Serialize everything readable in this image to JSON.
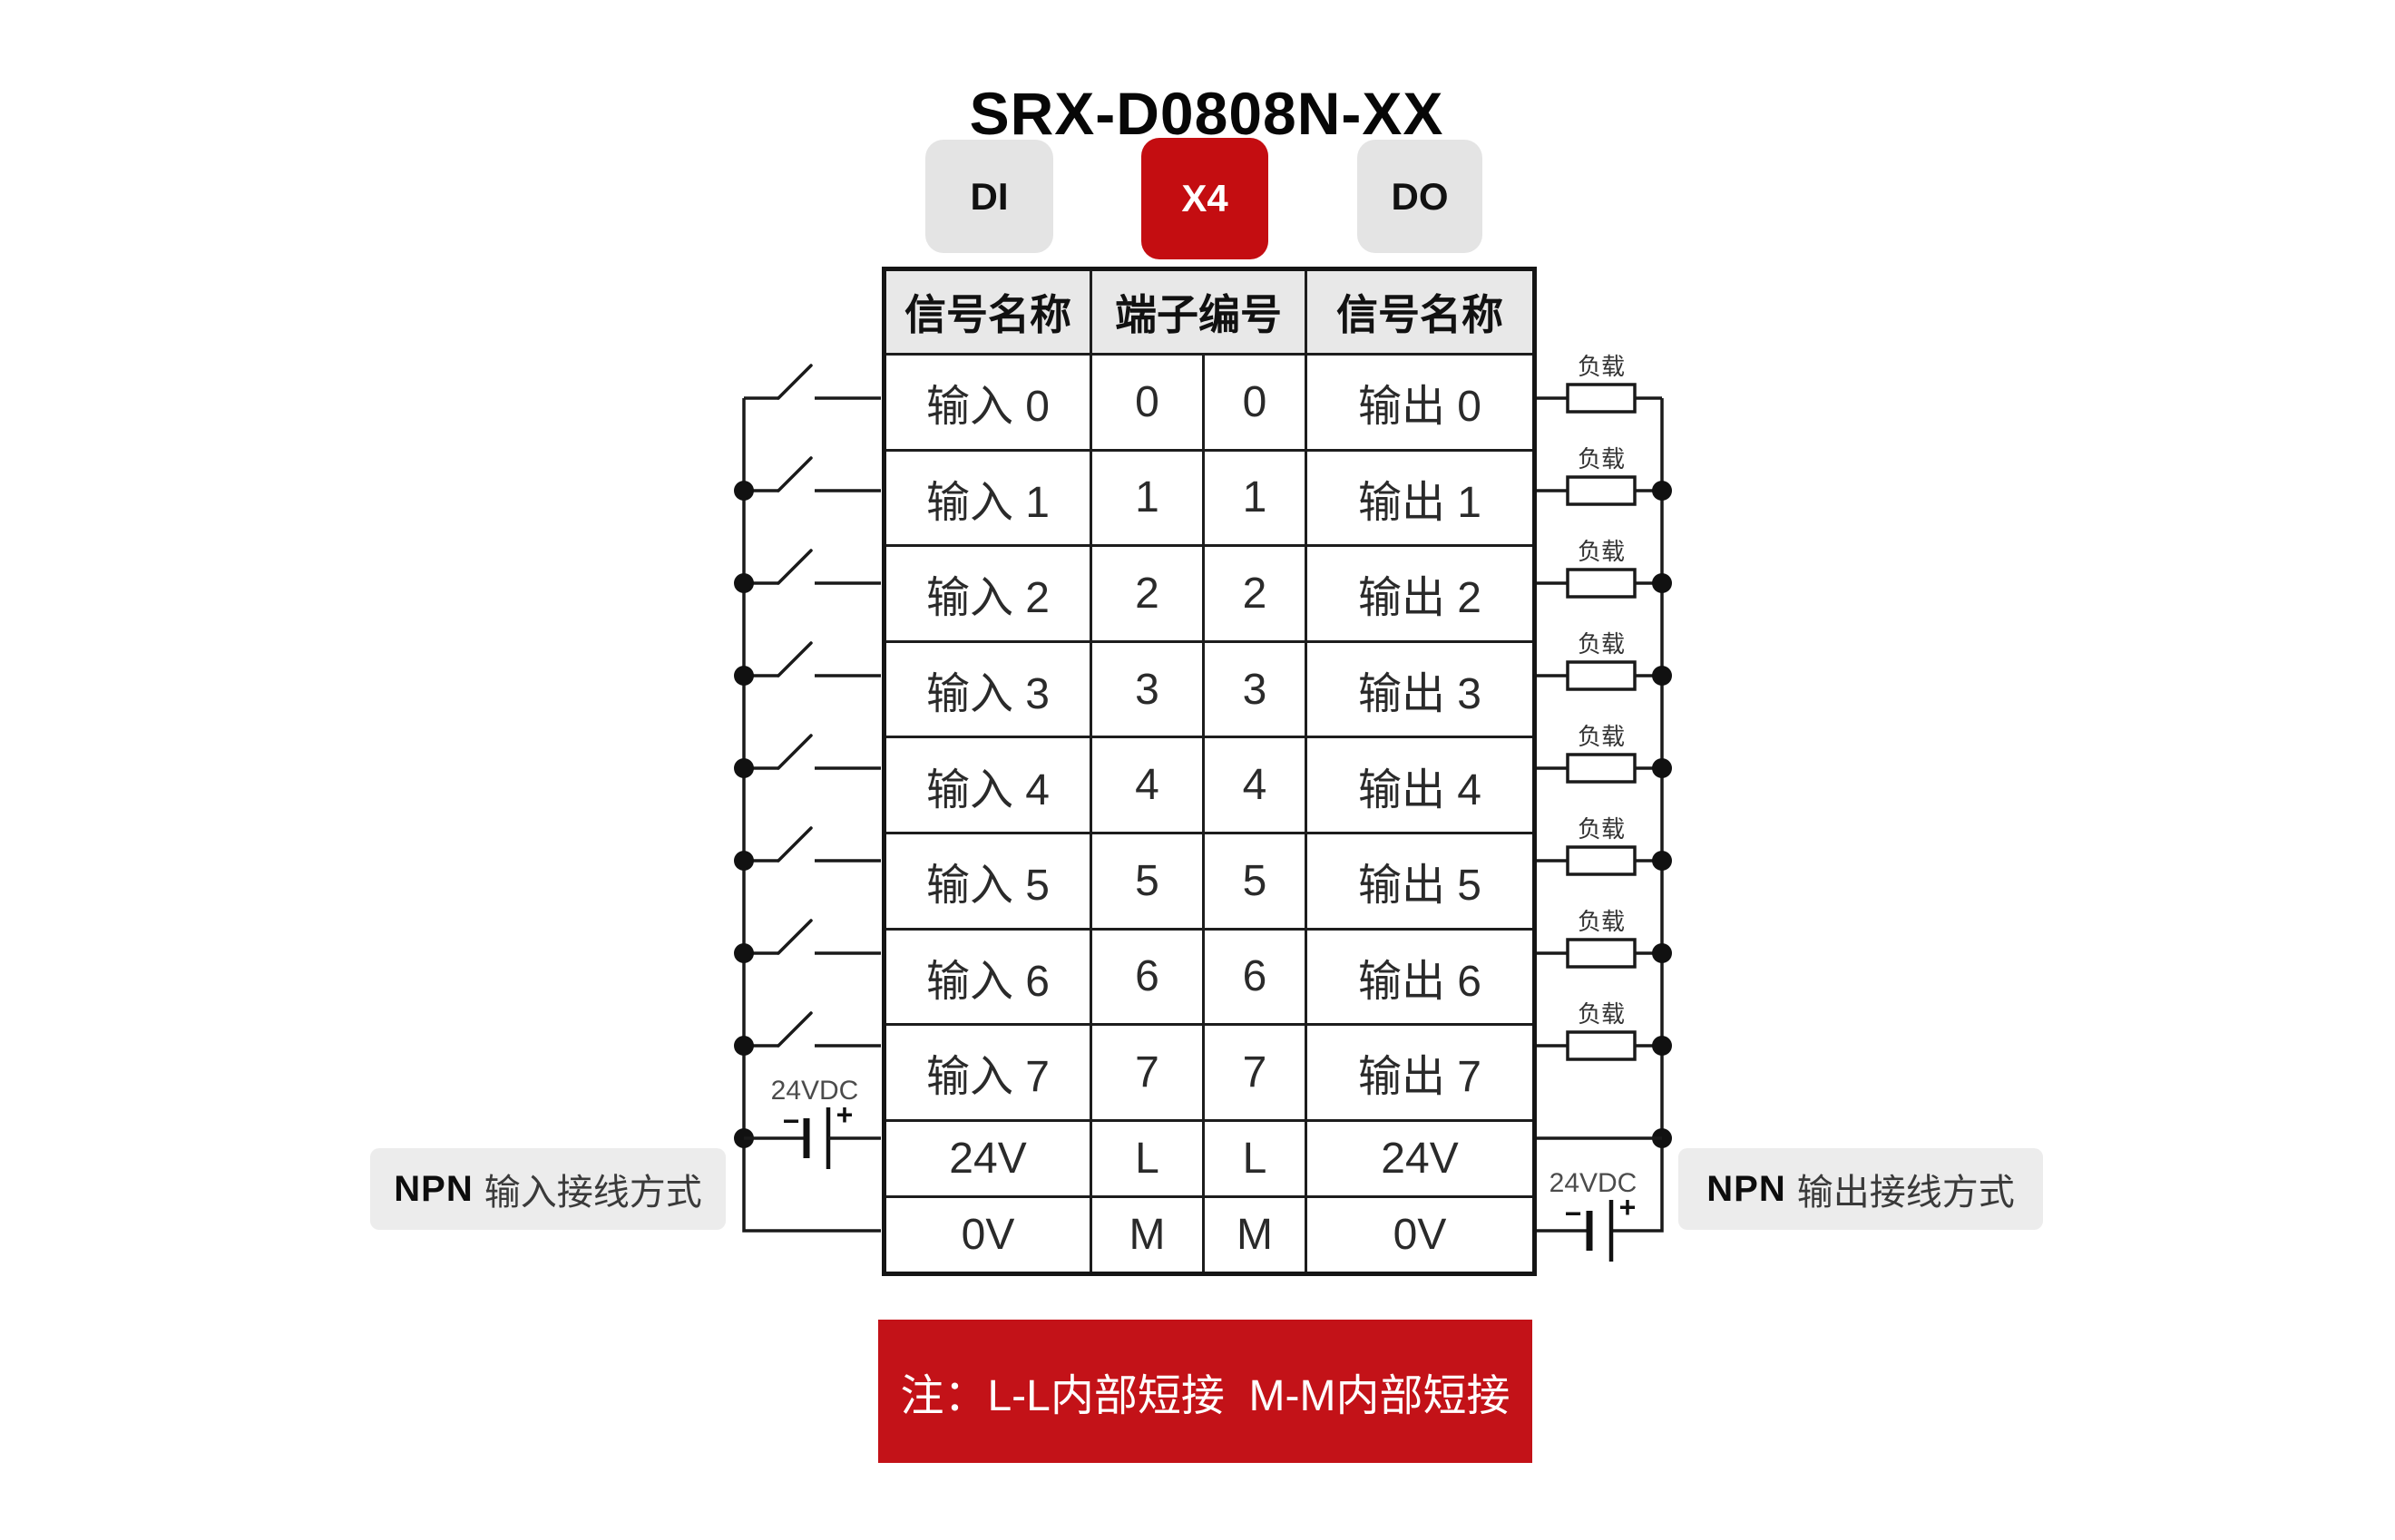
{
  "title": "SRX-D0808N-XX",
  "badges": {
    "di": "DI",
    "x4": "X4",
    "do": "DO"
  },
  "table": {
    "header_signal_left": "信号名称",
    "header_terminal": "端子编号",
    "header_signal_right": "信号名称",
    "rows": [
      {
        "left": "输入 0",
        "tl": "0",
        "tr": "0",
        "right": "输出 0"
      },
      {
        "left": "输入 1",
        "tl": "1",
        "tr": "1",
        "right": "输出 1"
      },
      {
        "left": "输入 2",
        "tl": "2",
        "tr": "2",
        "right": "输出 2"
      },
      {
        "left": "输入 3",
        "tl": "3",
        "tr": "3",
        "right": "输出 3"
      },
      {
        "left": "输入 4",
        "tl": "4",
        "tr": "4",
        "right": "输出 4"
      },
      {
        "left": "输入 5",
        "tl": "5",
        "tr": "5",
        "right": "输出 5"
      },
      {
        "left": "输入 6",
        "tl": "6",
        "tr": "6",
        "right": "输出 6"
      },
      {
        "left": "输入 7",
        "tl": "7",
        "tr": "7",
        "right": "输出 7"
      },
      {
        "left": "24V",
        "tl": "L",
        "tr": "L",
        "right": "24V"
      },
      {
        "left": "0V",
        "tl": "M",
        "tr": "M",
        "right": "0V"
      }
    ]
  },
  "left_circuit": {
    "supply": "24VDC",
    "minus": "−",
    "plus": "+"
  },
  "right_circuit": {
    "load": "负载",
    "supply": "24VDC",
    "minus": "−",
    "plus": "+"
  },
  "captions": {
    "left_bold": "NPN",
    "left_text": "输入接线方式",
    "right_bold": "NPN",
    "right_text": "输出接线方式"
  },
  "note": "注：L-L内部短接  M-M内部短接",
  "icons": {
    "switch": "switch-icon",
    "load": "load-resistor-icon",
    "battery": "battery-icon",
    "junction": "junction-dot"
  },
  "colors": {
    "badge_red": "#c40d11",
    "banner_red": "#c31218",
    "badge_gray": "#e4e4e4",
    "header_gray": "#e8e8e8",
    "caption_gray": "#ececec",
    "line": "#1a1a1a"
  }
}
